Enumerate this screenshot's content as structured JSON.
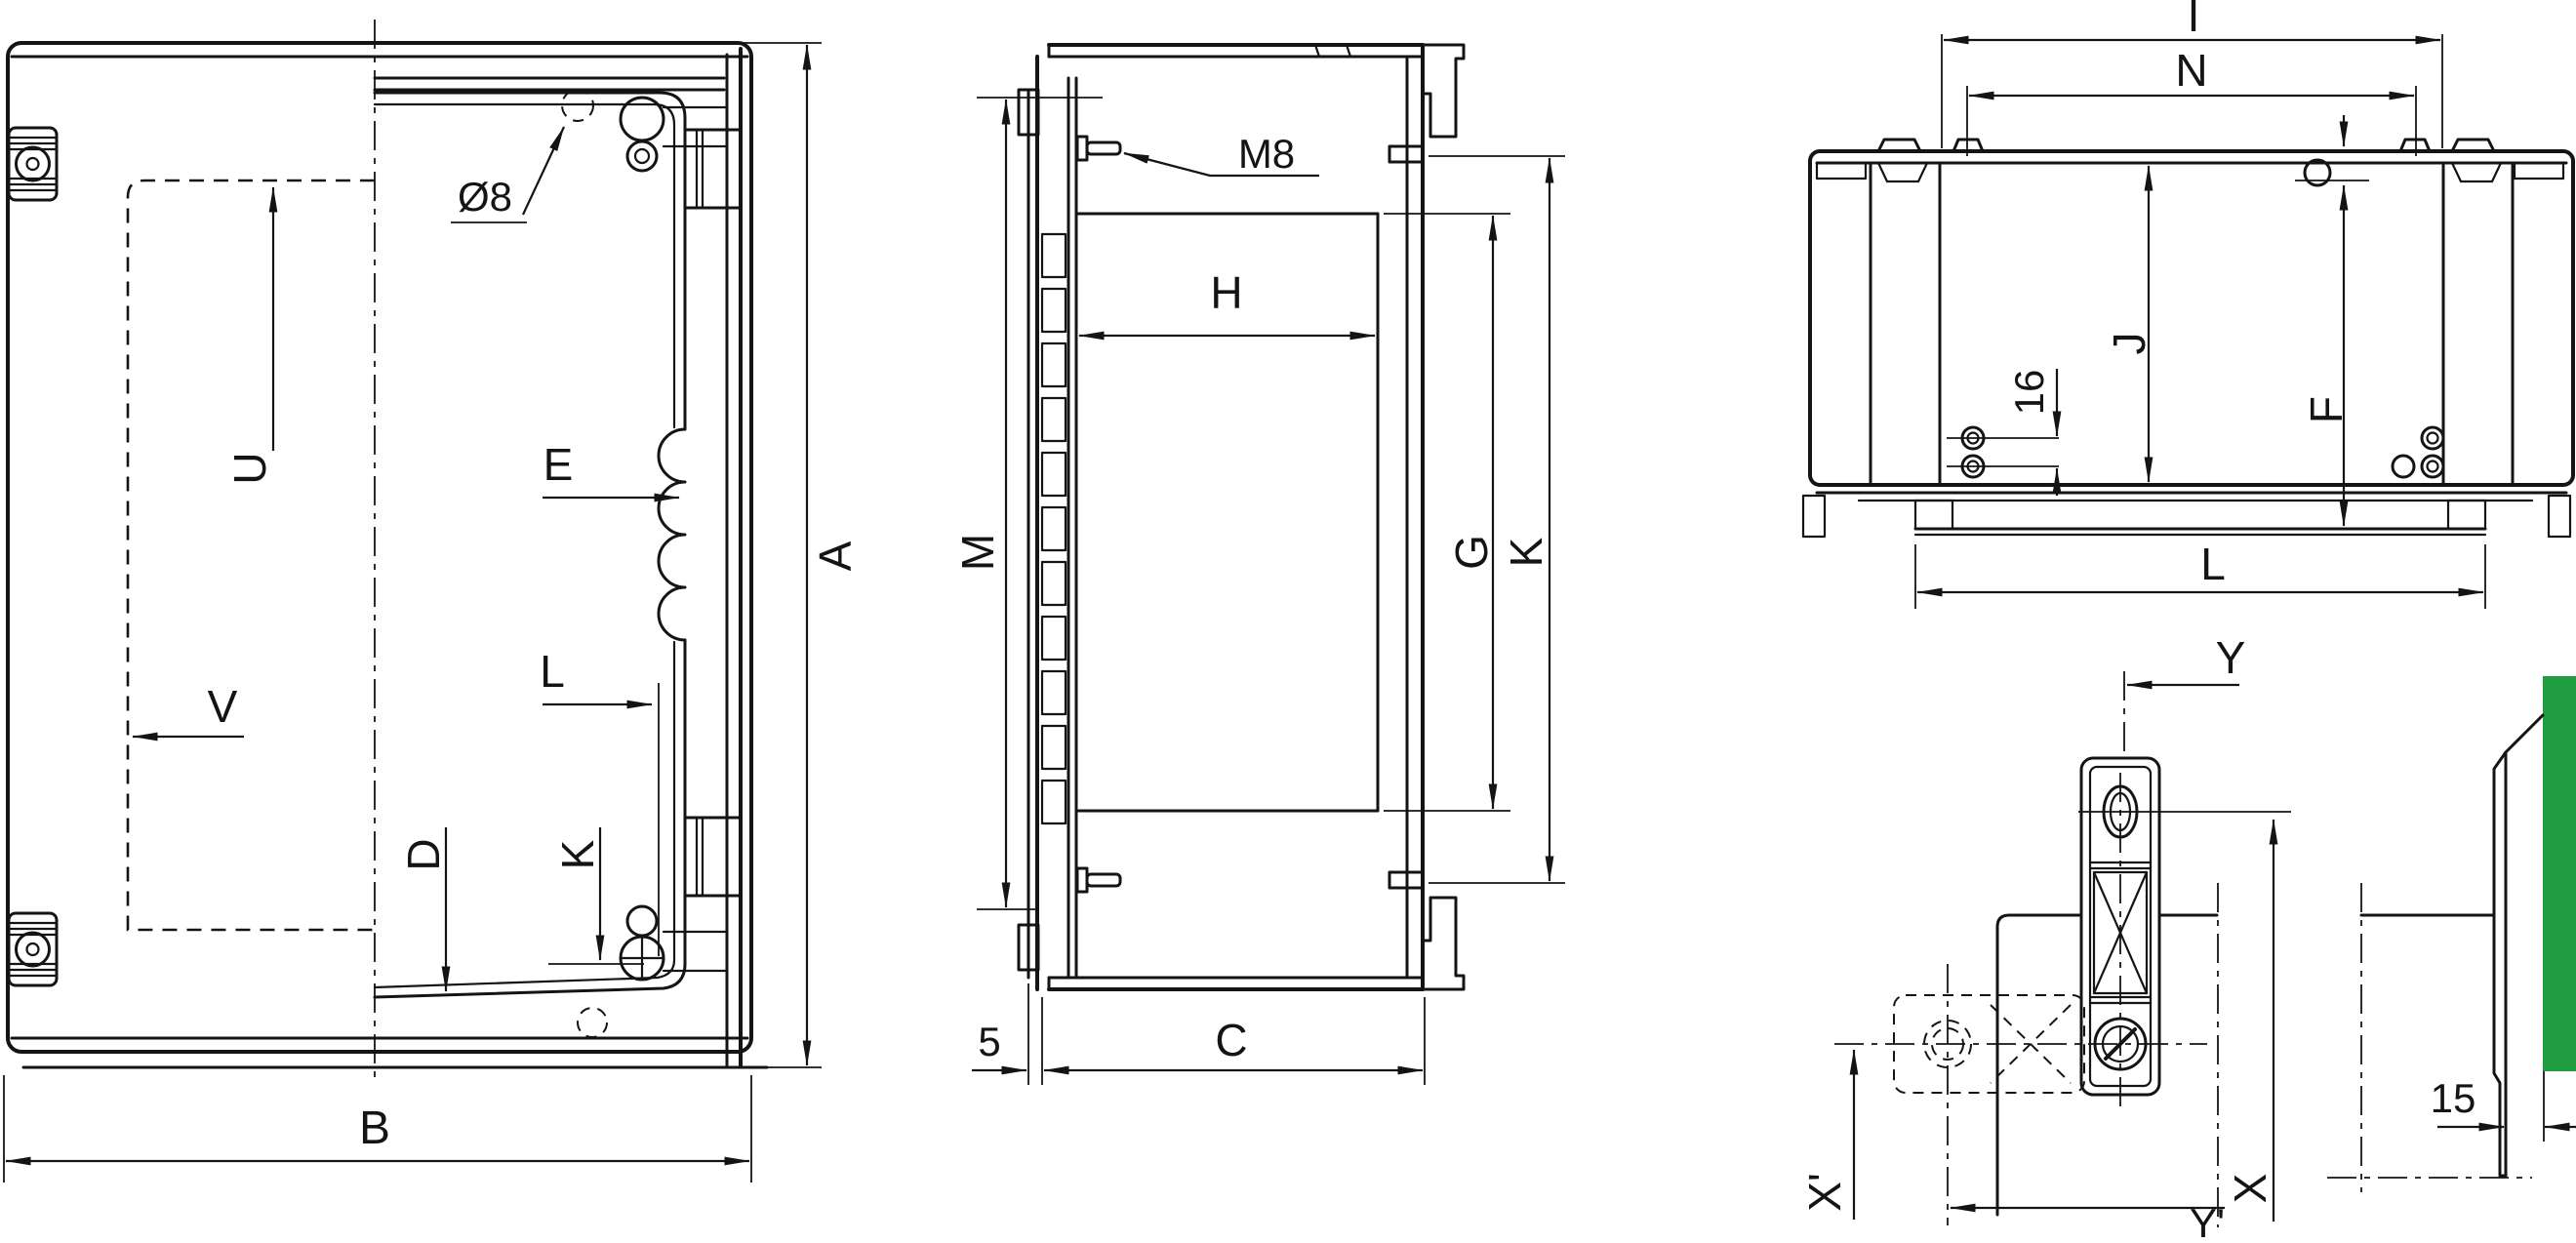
{
  "title": "Enclosure dimension drawing",
  "colors": {
    "wall_green": "#1e9c3f",
    "line": "#141414",
    "background": "#ffffff"
  },
  "views": {
    "front": {
      "dia8": "Ø8",
      "u": "U",
      "v": "V",
      "e": "E",
      "l": "L",
      "d": "D",
      "k": "K",
      "a": "A",
      "b": "B"
    },
    "side": {
      "m8": "M8",
      "h": "H",
      "m": "M",
      "g": "G",
      "k": "K",
      "five": "5",
      "c": "C"
    },
    "rear": {
      "i": "I",
      "n": "N",
      "j": "J",
      "f": "F",
      "sixteen": "16",
      "l": "L"
    },
    "detail": {
      "y": "Y",
      "x_prime": "X'",
      "x": "X",
      "y_prime": "Y'",
      "fifteen": "15"
    }
  }
}
